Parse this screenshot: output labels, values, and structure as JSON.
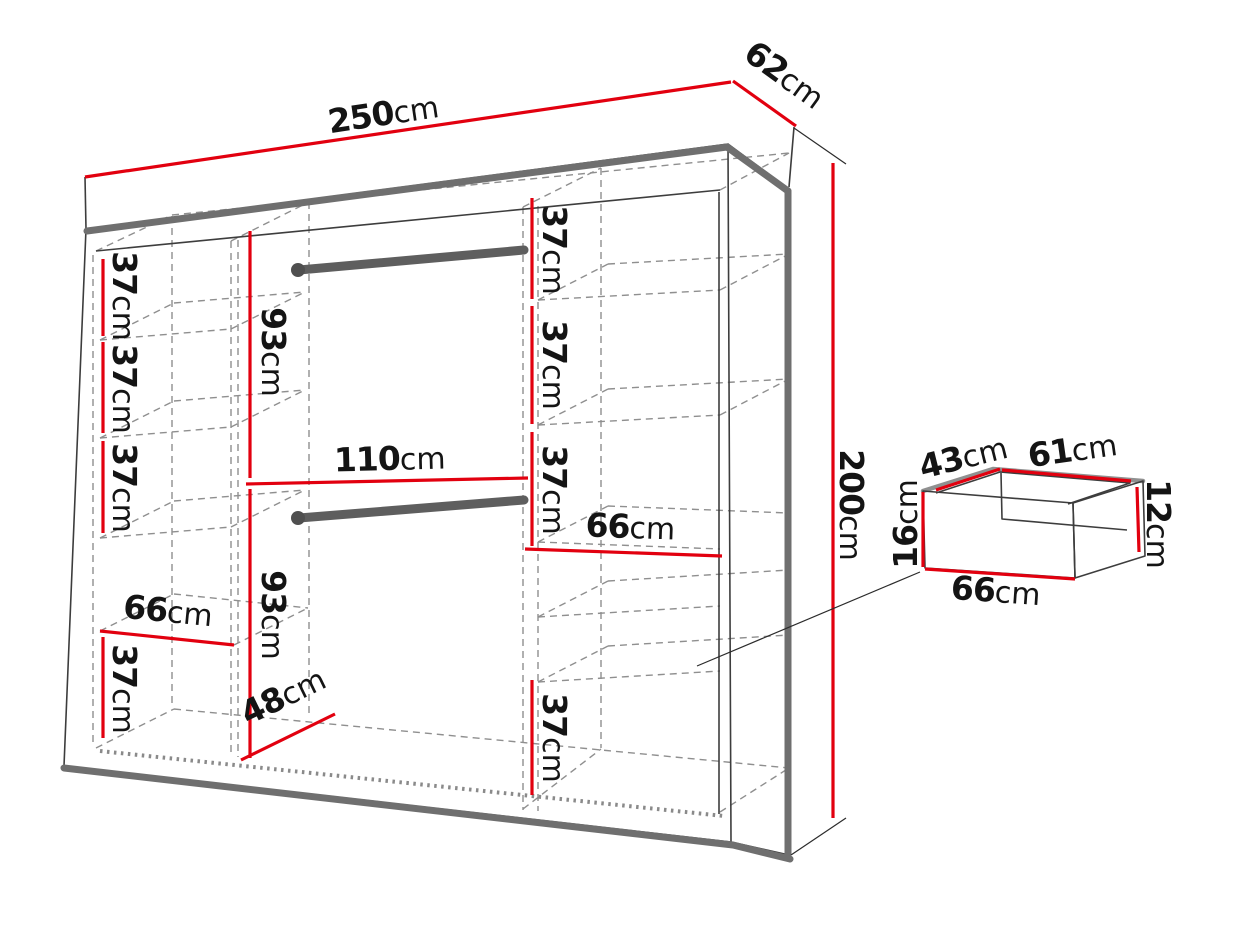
{
  "wardrobe": {
    "width": {
      "num": "250",
      "unit": "cm"
    },
    "depth": {
      "num": "62",
      "unit": "cm"
    },
    "height": {
      "num": "200",
      "unit": "cm"
    },
    "left_column": {
      "compartment1_height": {
        "num": "37",
        "unit": "cm"
      },
      "compartment2_height": {
        "num": "37",
        "unit": "cm"
      },
      "compartment3_height": {
        "num": "37",
        "unit": "cm"
      },
      "shelf_width": {
        "num": "66",
        "unit": "cm"
      },
      "bottom_compartment_height": {
        "num": "37",
        "unit": "cm"
      }
    },
    "middle_section": {
      "upper_hanging_height": {
        "num": "93",
        "unit": "cm"
      },
      "section_width": {
        "num": "110",
        "unit": "cm"
      },
      "lower_hanging_height": {
        "num": "93",
        "unit": "cm"
      },
      "floor_depth": {
        "num": "48",
        "unit": "cm"
      }
    },
    "right_column": {
      "compartment1_height": {
        "num": "37",
        "unit": "cm"
      },
      "compartment2_height": {
        "num": "37",
        "unit": "cm"
      },
      "compartment3_height": {
        "num": "37",
        "unit": "cm"
      },
      "shelf_width": {
        "num": "66",
        "unit": "cm"
      },
      "bottom_compartment_height": {
        "num": "37",
        "unit": "cm"
      }
    }
  },
  "drawer": {
    "inner_depth": {
      "num": "43",
      "unit": "cm"
    },
    "inner_width": {
      "num": "61",
      "unit": "cm"
    },
    "front_height": {
      "num": "16",
      "unit": "cm"
    },
    "back_height": {
      "num": "12",
      "unit": "cm"
    },
    "outer_width": {
      "num": "66",
      "unit": "cm"
    }
  },
  "colors": {
    "dimension_red": "#e2000f",
    "structure_gray": "#6f6f6f",
    "dashed_gray": "#8f8f8f",
    "outline_dark": "#3d3d3d",
    "background": "#ffffff"
  }
}
